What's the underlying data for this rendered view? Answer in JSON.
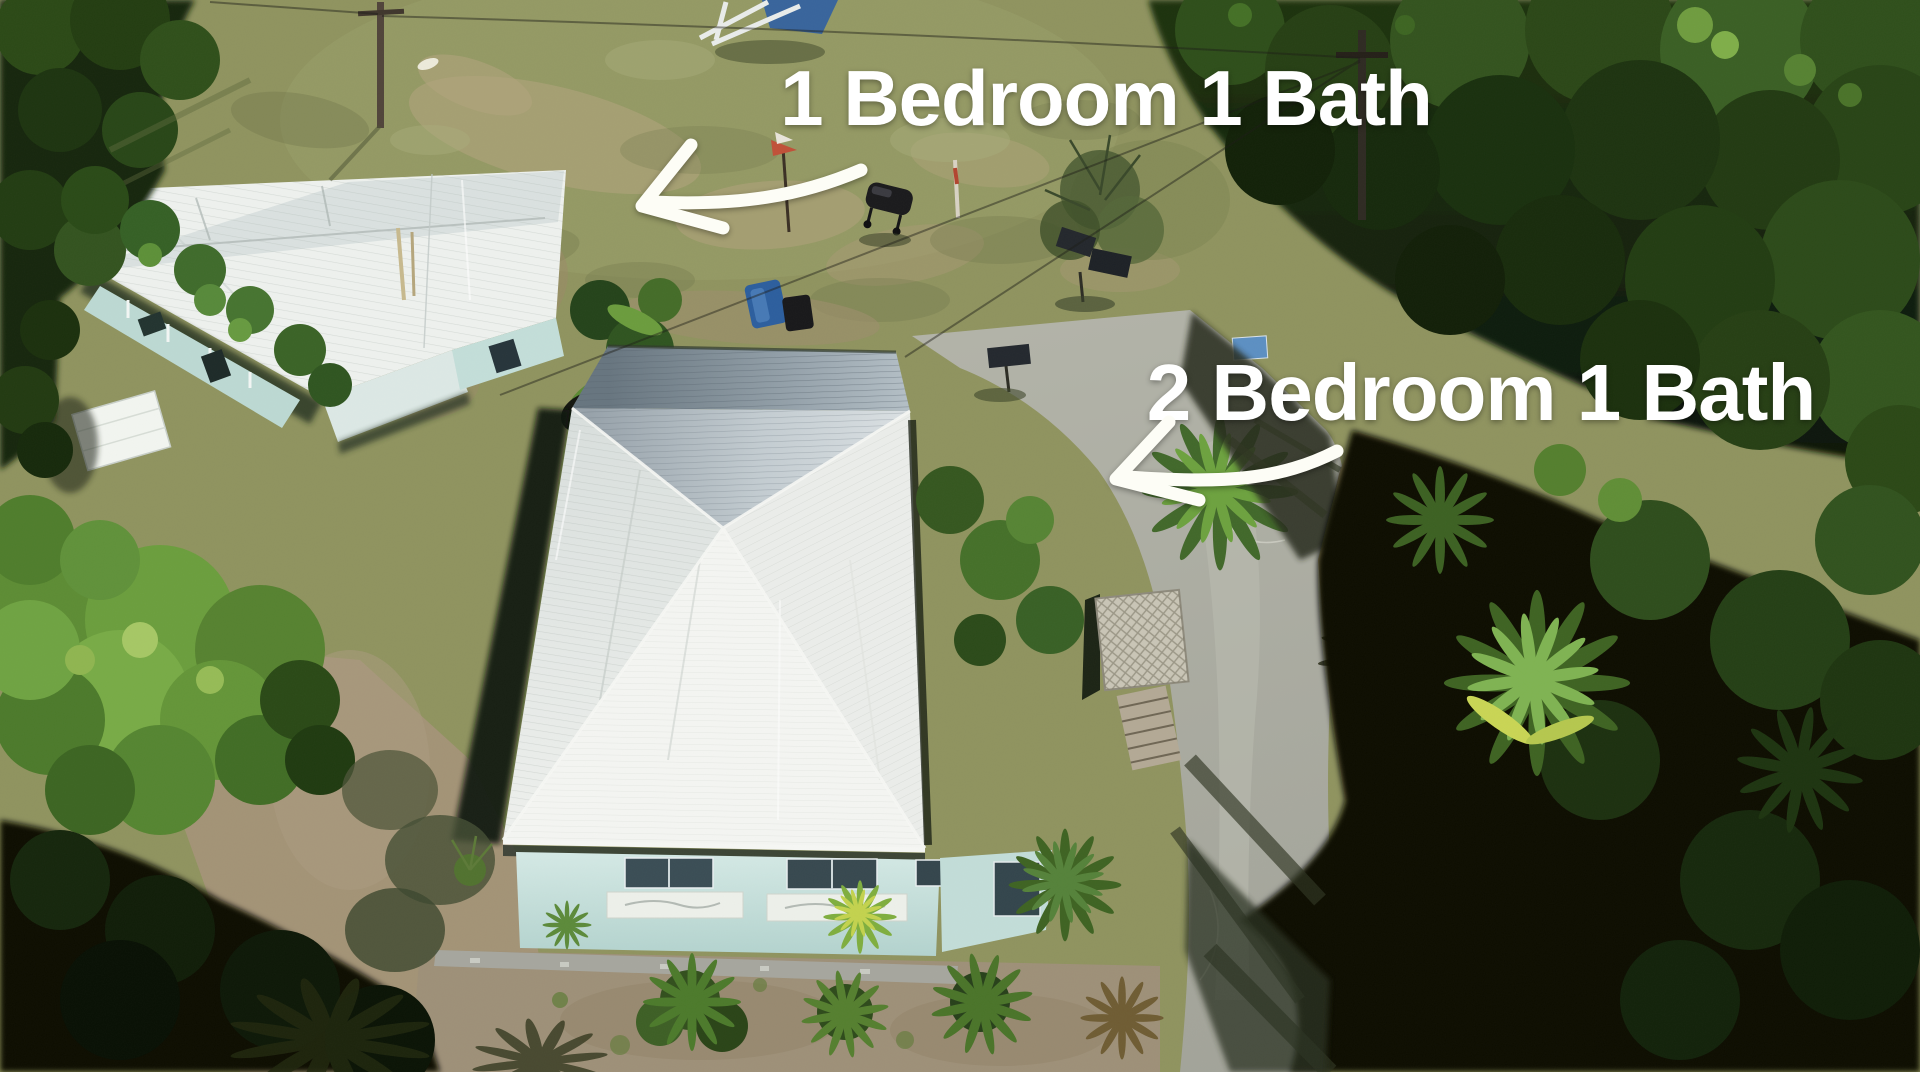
{
  "image": {
    "kind": "aerial-drone-photo",
    "description": "Overhead drone photo of a property with two light-teal houses with white metal roofs, a lawn, a concrete driveway and dense tree canopy",
    "width_px": 1920,
    "height_px": 1072
  },
  "annotations": {
    "small_house_label": {
      "text": "1 Bedroom 1 Bath",
      "color": "#ffffff"
    },
    "main_house_label": {
      "text": "2 Bedroom 1 Bath",
      "color": "#ffffff"
    },
    "arrows": [
      {
        "name": "arrow-to-1-bedroom-house",
        "points": "curved, pointing left toward small house",
        "color": "#fdfdf6"
      },
      {
        "name": "arrow-to-2-bedroom-house",
        "points": "curved, pointing left toward main house roof",
        "color": "#fdfdf6"
      }
    ]
  },
  "scene": {
    "elements": [
      "small-house-1br",
      "main-house-2br",
      "backyard-lawn",
      "concrete-driveway",
      "tree-canopy",
      "palm-trees",
      "garden-plants",
      "utility-poles"
    ],
    "palette": {
      "lawn": "#8d9260",
      "dirt": "#a3937a",
      "driveway": "#abaca1",
      "roof_white": "#eef0ed",
      "roof_metal_gray": "#8d99a4",
      "walls_aqua": "#c5e0dc",
      "tree_dark": "#101a09",
      "foliage_bright": "#6f9c3f"
    }
  }
}
